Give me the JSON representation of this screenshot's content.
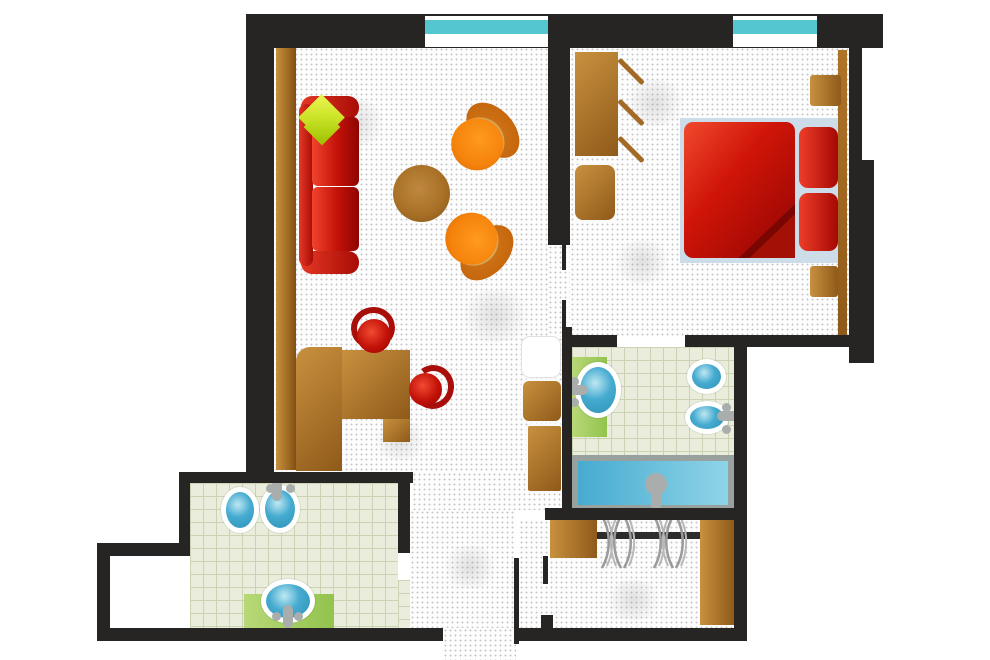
{
  "diagram": {
    "type": "floor-plan",
    "subject": "one-bedroom apartment suite, top-down furnished plan",
    "canvas_px": {
      "width": 990,
      "height": 660
    }
  },
  "colors": {
    "wall": "#272424",
    "glass": "#54c6d0",
    "floorbase": "#fdfdfd",
    "dot": "#c6c6c6",
    "tile": "#eaeddc",
    "tileline": "#cbd3b5",
    "wood1": "#c8913f",
    "wood2": "#8f5a1a",
    "wood3": "#b07428",
    "red2": "#c21108",
    "red3": "#8f0502",
    "red4": "#a80f0a",
    "green": "#c0e018",
    "orange1": "#f5830c",
    "orange2": "#c06008",
    "tan": "#d7a556",
    "mat1": "#b8d877",
    "mat2": "#93c34e",
    "water1": "#46abd0",
    "water2": "#8fd4e8",
    "blue1": "#2f93b8",
    "blue2": "#bfe8f2",
    "metal": "#a9adab",
    "rim": "#98a19d",
    "bedmat": "#ccdde9",
    "white": "#ffffff"
  },
  "rooms": [
    {
      "name": "living-room",
      "floor": "white-stippled",
      "windows": 1,
      "furniture": [
        "sideboard",
        "sofa",
        "sofa-accent-pillow",
        "coffee-table",
        "armchair-1",
        "armchair-2",
        "desk",
        "desk-chair-1",
        "desk-chair-2",
        "fridge",
        "cabinet-upper",
        "cabinet-lower"
      ]
    },
    {
      "name": "bedroom",
      "floor": "white-stippled",
      "windows": 1,
      "furniture": [
        "wardrobe",
        "wardrobe-open-doors",
        "nightstand-left",
        "bed-mat",
        "double-bed",
        "bed-pillow-1",
        "bed-pillow-2",
        "headboard",
        "nightstand-top-right",
        "nightstand-bottom-right"
      ]
    },
    {
      "name": "bathroom-main",
      "floor": "green-tile",
      "fixtures": [
        "washbasin",
        "toilet",
        "bidet",
        "bathtub"
      ],
      "accessories": [
        "basin-mat"
      ]
    },
    {
      "name": "bathroom-guest",
      "floor": "green-tile",
      "fixtures": [
        "bidet",
        "toilet",
        "washbasin"
      ],
      "accessories": [
        "basin-mat"
      ]
    },
    {
      "name": "walk-in-closet",
      "floor": "white-stippled",
      "furniture": [
        "cabinet-left",
        "clothes-rail",
        "cabinet-right"
      ],
      "hanger_count": 6
    },
    {
      "name": "entry-corridor",
      "floor": "white-stippled",
      "features": [
        "entrance-opening",
        "entry-door-leaf",
        "bathroom-door-opening"
      ]
    }
  ],
  "counts": {
    "windows": 2,
    "armchairs": 2,
    "desk_chairs": 2,
    "bed_pillows": 2,
    "hangers": 6,
    "washbasins": 2,
    "toilets": 2,
    "bidets": 2,
    "bathtubs": 1
  }
}
